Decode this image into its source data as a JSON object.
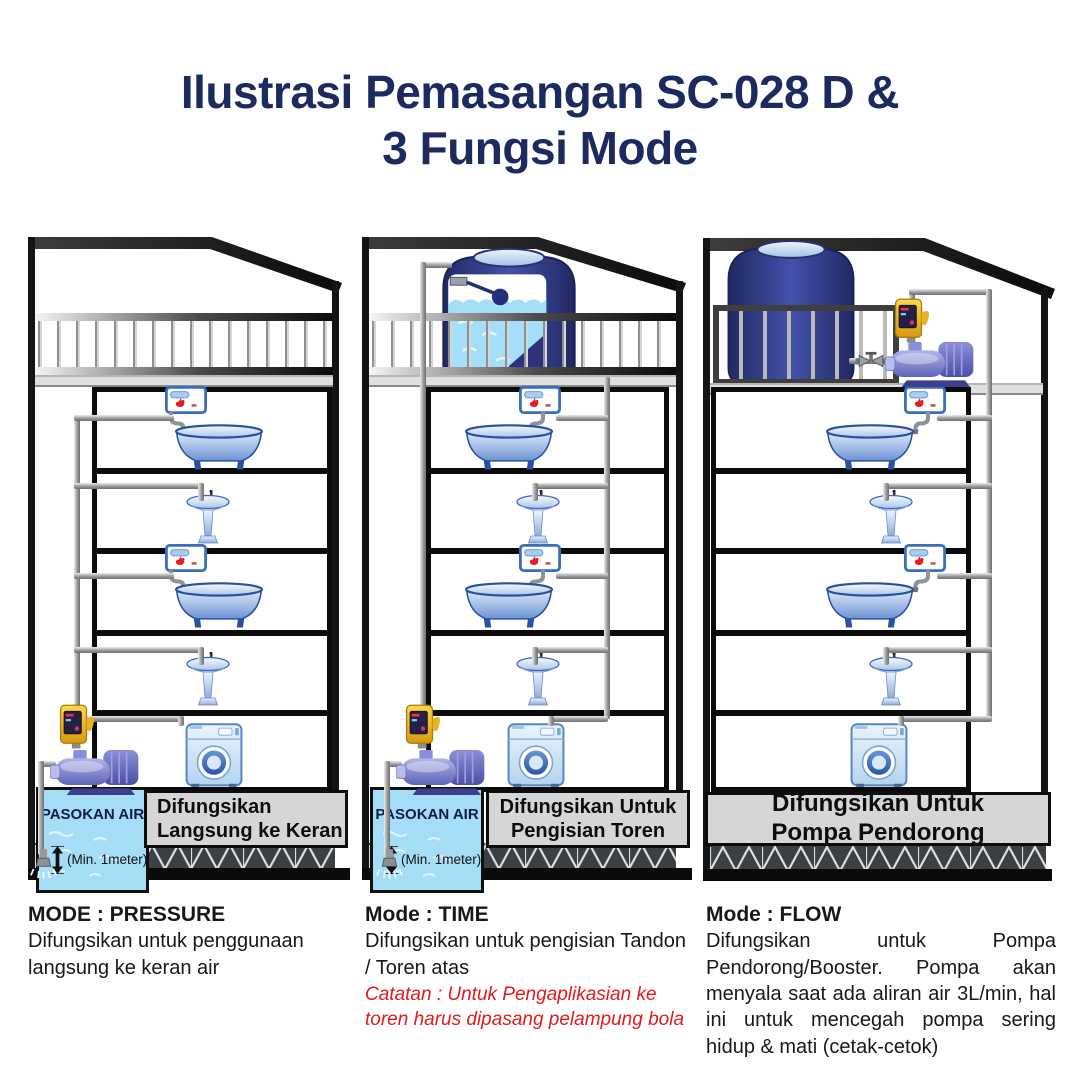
{
  "title": {
    "line1": "Ilustrasi Pemasangan SC-028 D &",
    "line2": "3 Fungsi Mode"
  },
  "houses": [
    {
      "caption_line1": "Difungsikan",
      "caption_line2": "Langsung ke Keran",
      "supply_label": "PASOKAN AIR",
      "min_label": "(Min. 1meter)"
    },
    {
      "caption_line1": "Difungsikan Untuk",
      "caption_line2": "Pengisian Toren",
      "supply_label": "PASOKAN AIR",
      "min_label": "(Min. 1meter)"
    },
    {
      "caption_line1": "Difungsikan Untuk",
      "caption_line2": "Pompa Pendorong"
    }
  ],
  "modes": [
    {
      "title": "MODE : PRESSURE",
      "desc": "Difungsikan untuk penggunaan langsung ke keran air"
    },
    {
      "title": "Mode : TIME",
      "desc": "Difungsikan untuk pengisian Tandon / Toren atas",
      "note": "Catatan : Untuk Pengaplikasian ke toren harus dipasang pelampung bola"
    },
    {
      "title": "Mode : FLOW",
      "desc": "Difungsikan untuk Pompa Pendorong/Booster. Pompa akan menyala saat ada aliran air 3L/min, hal ini untuk mencegah pompa sering hidup & mati (cetak-cetok)"
    }
  ],
  "colors": {
    "title_navy": "#1c2a60",
    "note_red": "#e21a1c",
    "caption_bg": "#d6d6d6",
    "supply_water": "#a5ddf6",
    "tank_navy": "#2b337c",
    "controller_yellow": "#f3b61f",
    "pump_blue": "#6a71c2",
    "heater_flame_red": "#e32020",
    "pipe_gray": "#9c9c9c"
  }
}
